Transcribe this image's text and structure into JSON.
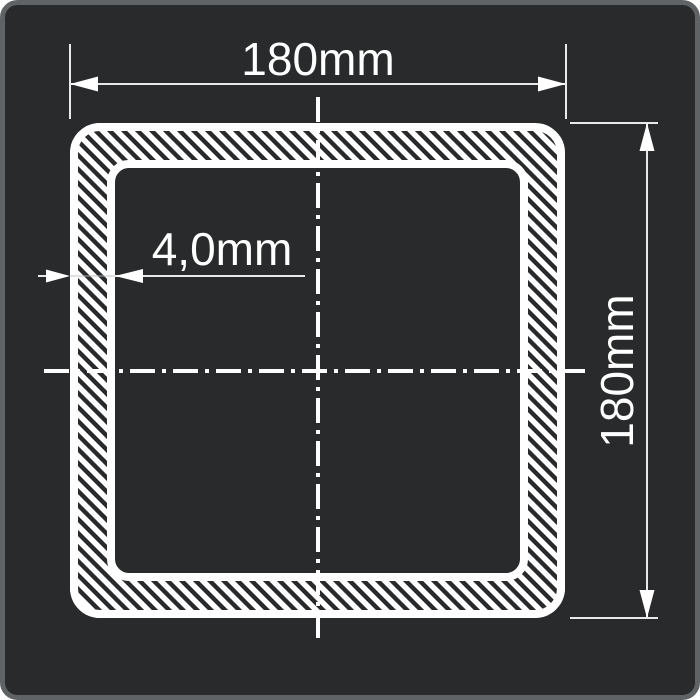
{
  "drawing": {
    "dimensions": {
      "width_label": "180mm",
      "height_label": "180mm",
      "wall_thickness_label": "4,0mm"
    },
    "colors": {
      "canvas_background": "#282a2b",
      "panel_border": "#606365",
      "profile_line": "#ffffff",
      "dimension_line": "#e8e8e8"
    }
  }
}
